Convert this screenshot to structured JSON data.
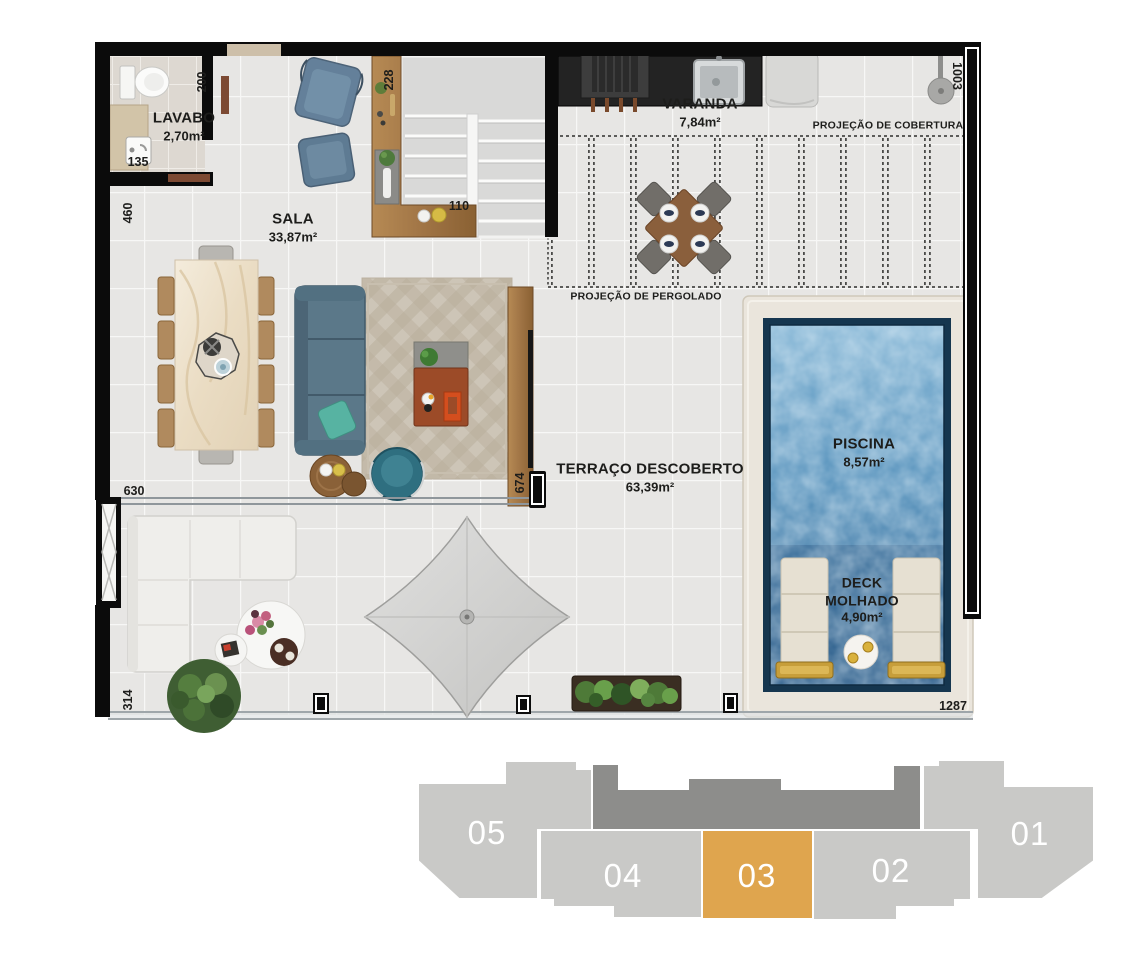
{
  "plan": {
    "rooms": [
      {
        "name": "LAVABO",
        "area": "2,70m²"
      },
      {
        "name": "SALA",
        "area": "33,87m²"
      },
      {
        "name": "VARANDA",
        "area": "7,84m²"
      },
      {
        "name": "TERRAÇO DESCOBERTO",
        "area": "63,39m²"
      },
      {
        "name": "PISCINA",
        "area": "8,57m²"
      },
      {
        "name": "DECK MOLHADO",
        "area": "4,90m²"
      }
    ],
    "projections": {
      "cobertura": "PROJEÇÃO DE COBERTURA",
      "pergolado": "PROJEÇÃO DE PERGOLADO"
    },
    "dimensions": {
      "d200": "200",
      "d228": "228",
      "d1003": "1003",
      "d135": "135",
      "d460": "460",
      "d110": "110",
      "d630": "630",
      "d674": "674",
      "d314": "314",
      "d1287": "1287"
    }
  },
  "keyplan": {
    "units": [
      {
        "label": "05"
      },
      {
        "label": "04"
      },
      {
        "label": "03"
      },
      {
        "label": "02"
      },
      {
        "label": "01"
      }
    ],
    "highlighted_unit": "03",
    "colors": {
      "unit": "#c9c9c7",
      "core": "#8d8d8b",
      "highlight": "#dfa54e",
      "label": "#ffffff"
    }
  }
}
